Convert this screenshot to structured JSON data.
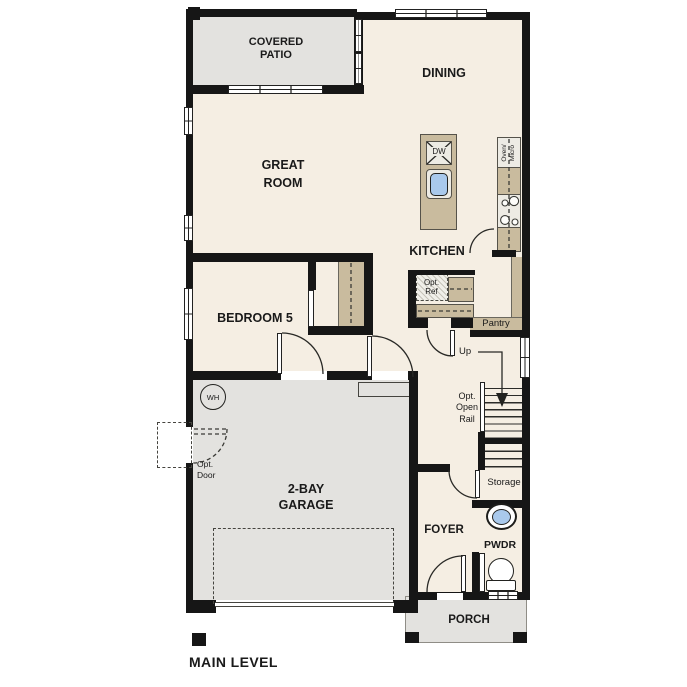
{
  "plan_title": "MAIN LEVEL",
  "rooms": {
    "covered_patio": {
      "line1": "COVERED",
      "line2": "PATIO"
    },
    "dining": {
      "label": "DINING"
    },
    "great_room": {
      "line1": "GREAT",
      "line2": "ROOM"
    },
    "kitchen": {
      "label": "KITCHEN"
    },
    "bedroom5": {
      "label": "BEDROOM 5"
    },
    "garage": {
      "line1": "2-BAY",
      "line2": "GARAGE"
    },
    "foyer": {
      "label": "FOYER"
    },
    "powder": {
      "label": "PWDR"
    },
    "porch": {
      "label": "PORCH"
    },
    "pantry": {
      "label": "Pantry"
    },
    "storage": {
      "label": "Storage"
    }
  },
  "labels": {
    "up": "Up",
    "opt_open_rail": {
      "line1": "Opt.",
      "line2": "Open",
      "line3": "Rail"
    },
    "opt_door": {
      "line1": "Opt.",
      "line2": "Door"
    },
    "opt_ref": {
      "line1": "Opt.",
      "line2": "Ref"
    },
    "water_heater": "WH",
    "dishwasher": "DW",
    "oven_micro": {
      "line1": "Oven/",
      "line2": "Micro"
    }
  },
  "colors": {
    "floor": "#f5eee3",
    "outdoor": "#e3e2df",
    "wall": "#161616",
    "counter": "#c9bb9e",
    "appliance": "#edebe4",
    "sink": "#a9c9ec",
    "text": "#1a1a1a"
  }
}
